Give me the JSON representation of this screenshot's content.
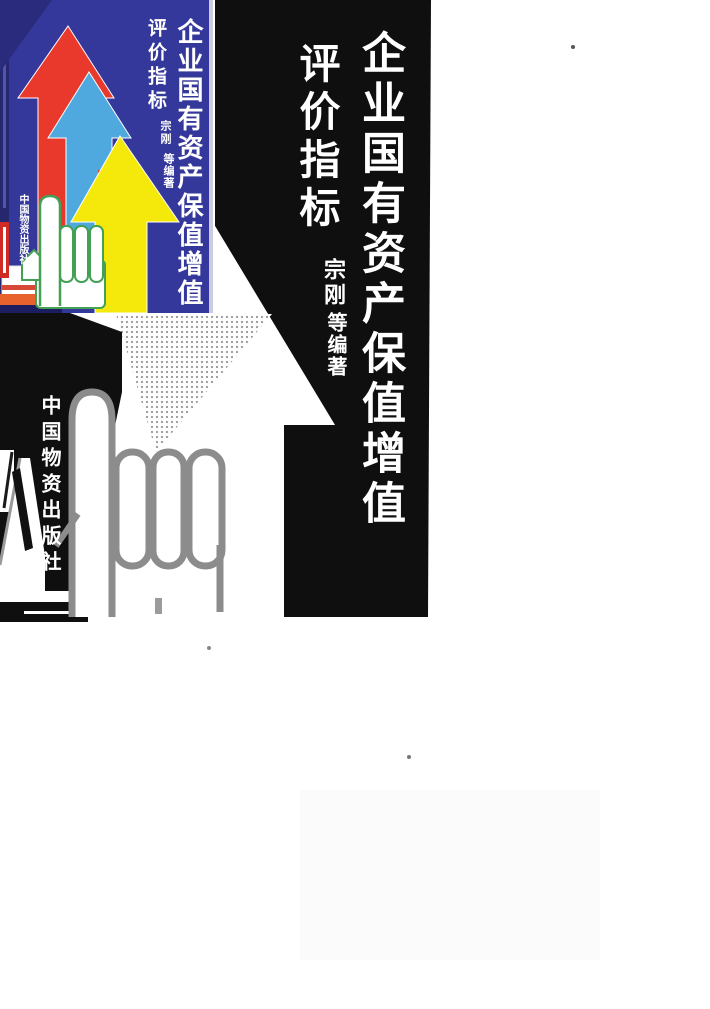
{
  "book": {
    "title": "企业国有资产保值增值",
    "subtitle": "评价指标",
    "author": "宗刚",
    "author_role": "等编著",
    "publisher": "中国物资出版社"
  },
  "colors": {
    "page_background": "#ffffff",
    "panel_black": "#0f0f0f",
    "thumb_background_blue": "#35389b",
    "thumb_edge_navy": "#26276f",
    "arrow_red": "#e8392c",
    "arrow_light_blue": "#4fa9de",
    "arrow_yellow": "#f5e90c",
    "hand_outline_green": "#43a055",
    "hand_outline_gray": "#8c8c8c",
    "truck_orange": "#e8622d",
    "text_white": "#ffffff"
  },
  "artwork": {
    "motifs": [
      "red-up-arrow",
      "light-blue-up-arrow",
      "yellow-up-arrow",
      "white-up-arrow-bw",
      "pointing-hand",
      "halftone-triangle",
      "delivery-truck",
      "publisher-sign-post"
    ]
  }
}
